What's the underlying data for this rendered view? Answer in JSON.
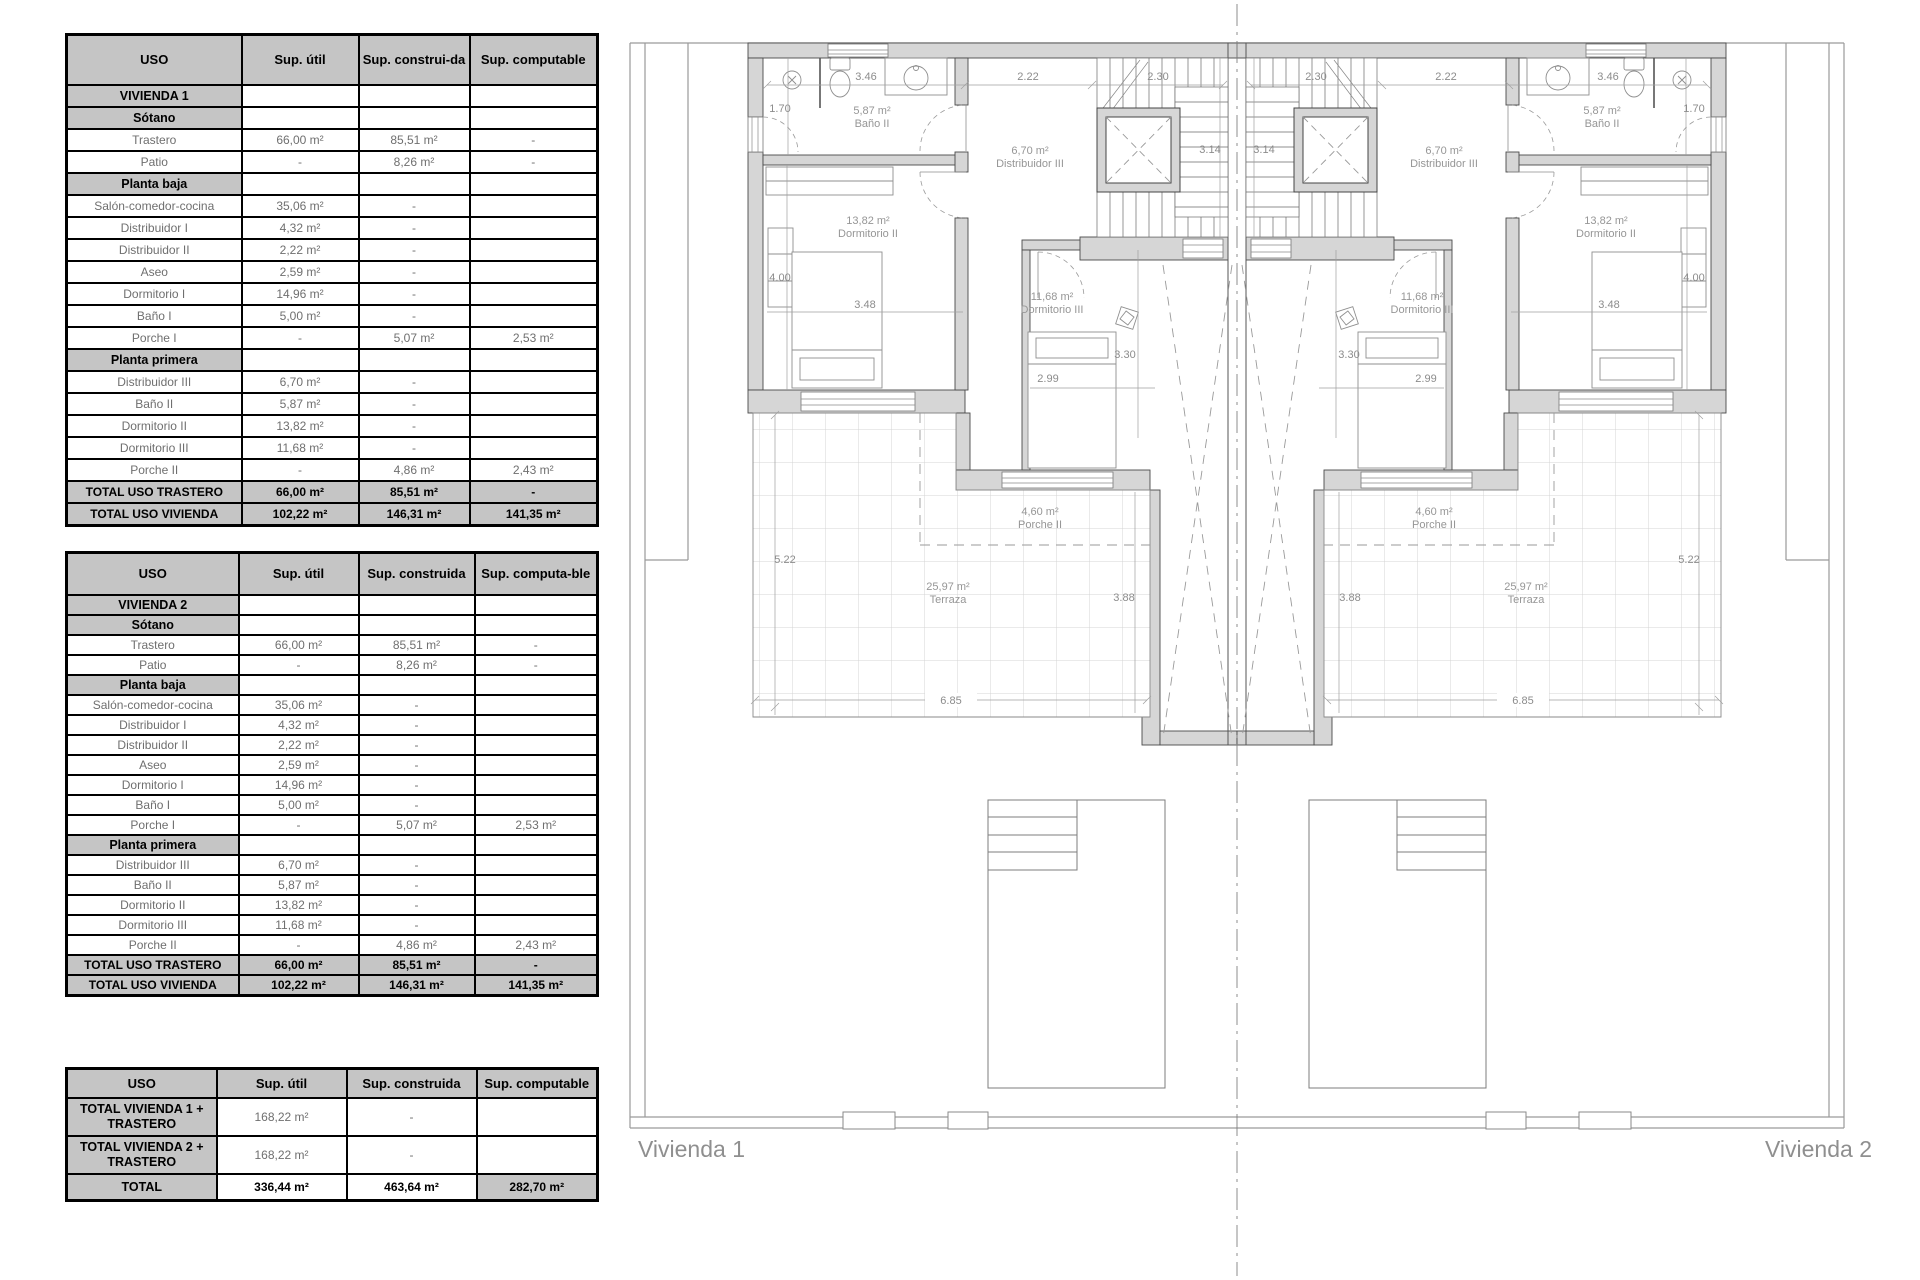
{
  "tables": {
    "table1": {
      "colw": [
        175,
        117,
        111,
        128
      ],
      "headers": [
        "USO",
        "Sup. útil",
        "Sup. construi-da",
        "Sup. computable"
      ],
      "rows": [
        [
          {
            "t": "VIVIENDA 1",
            "c": "sec"
          },
          {
            "t": "",
            "c": ""
          },
          {
            "t": "",
            "c": ""
          },
          {
            "t": "",
            "c": ""
          }
        ],
        [
          {
            "t": "Sótano",
            "c": "sec"
          },
          {
            "t": "",
            "c": ""
          },
          {
            "t": "",
            "c": ""
          },
          {
            "t": "",
            "c": ""
          }
        ],
        [
          {
            "t": "Trastero",
            "c": "dat"
          },
          {
            "t": "66,00 m²",
            "c": "dat"
          },
          {
            "t": "85,51 m²",
            "c": "dat"
          },
          {
            "t": "-",
            "c": "dat"
          }
        ],
        [
          {
            "t": "Patio",
            "c": "dat"
          },
          {
            "t": "-",
            "c": "dat"
          },
          {
            "t": "8,26 m²",
            "c": "dat"
          },
          {
            "t": "-",
            "c": "dat"
          }
        ],
        [
          {
            "t": "Planta baja",
            "c": "sec"
          },
          {
            "t": "",
            "c": ""
          },
          {
            "t": "",
            "c": ""
          },
          {
            "t": "",
            "c": ""
          }
        ],
        [
          {
            "t": "Salón-comedor-cocina",
            "c": "dat"
          },
          {
            "t": "35,06 m²",
            "c": "dat"
          },
          {
            "t": "-",
            "c": "dat"
          },
          {
            "t": "",
            "c": ""
          }
        ],
        [
          {
            "t": "Distribuidor I",
            "c": "dat"
          },
          {
            "t": "4,32 m²",
            "c": "dat"
          },
          {
            "t": "-",
            "c": "dat"
          },
          {
            "t": "",
            "c": ""
          }
        ],
        [
          {
            "t": "Distribuidor II",
            "c": "dat"
          },
          {
            "t": "2,22 m²",
            "c": "dat"
          },
          {
            "t": "-",
            "c": "dat"
          },
          {
            "t": "",
            "c": ""
          }
        ],
        [
          {
            "t": "Aseo",
            "c": "dat"
          },
          {
            "t": "2,59 m²",
            "c": "dat"
          },
          {
            "t": "-",
            "c": "dat"
          },
          {
            "t": "",
            "c": ""
          }
        ],
        [
          {
            "t": "Dormitorio I",
            "c": "dat"
          },
          {
            "t": "14,96 m²",
            "c": "dat"
          },
          {
            "t": "-",
            "c": "dat"
          },
          {
            "t": "",
            "c": ""
          }
        ],
        [
          {
            "t": "Baño I",
            "c": "dat"
          },
          {
            "t": "5,00 m²",
            "c": "dat"
          },
          {
            "t": "-",
            "c": "dat"
          },
          {
            "t": "",
            "c": ""
          }
        ],
        [
          {
            "t": "Porche I",
            "c": "dat"
          },
          {
            "t": "-",
            "c": "dat"
          },
          {
            "t": "5,07 m²",
            "c": "dat"
          },
          {
            "t": "2,53 m²",
            "c": "dat"
          }
        ],
        [
          {
            "t": "Planta primera",
            "c": "sec"
          },
          {
            "t": "",
            "c": ""
          },
          {
            "t": "",
            "c": ""
          },
          {
            "t": "",
            "c": ""
          }
        ],
        [
          {
            "t": "Distribuidor III",
            "c": "dat"
          },
          {
            "t": "6,70 m²",
            "c": "dat"
          },
          {
            "t": "-",
            "c": "dat"
          },
          {
            "t": "",
            "c": ""
          }
        ],
        [
          {
            "t": "Baño II",
            "c": "dat"
          },
          {
            "t": "5,87 m²",
            "c": "dat"
          },
          {
            "t": "-",
            "c": "dat"
          },
          {
            "t": "",
            "c": ""
          }
        ],
        [
          {
            "t": "Dormitorio II",
            "c": "dat"
          },
          {
            "t": "13,82 m²",
            "c": "dat"
          },
          {
            "t": "-",
            "c": "dat"
          },
          {
            "t": "",
            "c": ""
          }
        ],
        [
          {
            "t": "Dormitorio III",
            "c": "dat"
          },
          {
            "t": "11,68 m²",
            "c": "dat"
          },
          {
            "t": "-",
            "c": "dat"
          },
          {
            "t": "",
            "c": ""
          }
        ],
        [
          {
            "t": "Porche II",
            "c": "dat"
          },
          {
            "t": "-",
            "c": "dat"
          },
          {
            "t": "4,86 m²",
            "c": "dat"
          },
          {
            "t": "2,43 m²",
            "c": "dat"
          }
        ],
        [
          {
            "t": "TOTAL USO TRASTERO",
            "c": "tot"
          },
          {
            "t": "66,00 m²",
            "c": "tot"
          },
          {
            "t": "85,51 m²",
            "c": "tot"
          },
          {
            "t": "-",
            "c": "tot"
          }
        ],
        [
          {
            "t": "TOTAL USO VIVIENDA",
            "c": "tot"
          },
          {
            "t": "102,22 m²",
            "c": "tot"
          },
          {
            "t": "146,31 m²",
            "c": "tot"
          },
          {
            "t": "141,35 m²",
            "c": "tot"
          }
        ]
      ]
    },
    "table2": {
      "colw": [
        172,
        120,
        116,
        123
      ],
      "headers": [
        "USO",
        "Sup. útil",
        "Sup. construida",
        "Sup. computa-ble"
      ],
      "rows": [
        [
          {
            "t": "VIVIENDA 2",
            "c": "sec"
          },
          {
            "t": "",
            "c": ""
          },
          {
            "t": "",
            "c": ""
          },
          {
            "t": "",
            "c": ""
          }
        ],
        [
          {
            "t": "Sótano",
            "c": "sec"
          },
          {
            "t": "",
            "c": ""
          },
          {
            "t": "",
            "c": ""
          },
          {
            "t": "",
            "c": ""
          }
        ],
        [
          {
            "t": "Trastero",
            "c": "dat"
          },
          {
            "t": "66,00 m²",
            "c": "dat"
          },
          {
            "t": "85,51 m²",
            "c": "dat"
          },
          {
            "t": "-",
            "c": "dat"
          }
        ],
        [
          {
            "t": "Patio",
            "c": "dat"
          },
          {
            "t": "-",
            "c": "dat"
          },
          {
            "t": "8,26 m²",
            "c": "dat"
          },
          {
            "t": "-",
            "c": "dat"
          }
        ],
        [
          {
            "t": "Planta baja",
            "c": "sec"
          },
          {
            "t": "",
            "c": ""
          },
          {
            "t": "",
            "c": ""
          },
          {
            "t": "",
            "c": ""
          }
        ],
        [
          {
            "t": "Salón-comedor-cocina",
            "c": "dat"
          },
          {
            "t": "35,06 m²",
            "c": "dat"
          },
          {
            "t": "-",
            "c": "dat"
          },
          {
            "t": "",
            "c": ""
          }
        ],
        [
          {
            "t": "Distribuidor I",
            "c": "dat"
          },
          {
            "t": "4,32 m²",
            "c": "dat"
          },
          {
            "t": "-",
            "c": "dat"
          },
          {
            "t": "",
            "c": ""
          }
        ],
        [
          {
            "t": "Distribuidor II",
            "c": "dat"
          },
          {
            "t": "2,22 m²",
            "c": "dat"
          },
          {
            "t": "-",
            "c": "dat"
          },
          {
            "t": "",
            "c": ""
          }
        ],
        [
          {
            "t": "Aseo",
            "c": "dat"
          },
          {
            "t": "2,59 m²",
            "c": "dat"
          },
          {
            "t": "-",
            "c": "dat"
          },
          {
            "t": "",
            "c": ""
          }
        ],
        [
          {
            "t": "Dormitorio I",
            "c": "dat"
          },
          {
            "t": "14,96 m²",
            "c": "dat"
          },
          {
            "t": "-",
            "c": "dat"
          },
          {
            "t": "",
            "c": ""
          }
        ],
        [
          {
            "t": "Baño I",
            "c": "dat"
          },
          {
            "t": "5,00 m²",
            "c": "dat"
          },
          {
            "t": "-",
            "c": "dat"
          },
          {
            "t": "",
            "c": ""
          }
        ],
        [
          {
            "t": "Porche I",
            "c": "dat"
          },
          {
            "t": "-",
            "c": "dat"
          },
          {
            "t": "5,07 m²",
            "c": "dat"
          },
          {
            "t": "2,53 m²",
            "c": "dat"
          }
        ],
        [
          {
            "t": "Planta primera",
            "c": "sec"
          },
          {
            "t": "",
            "c": ""
          },
          {
            "t": "",
            "c": ""
          },
          {
            "t": "",
            "c": ""
          }
        ],
        [
          {
            "t": "Distribuidor III",
            "c": "dat"
          },
          {
            "t": "6,70 m²",
            "c": "dat"
          },
          {
            "t": "-",
            "c": "dat"
          },
          {
            "t": "",
            "c": ""
          }
        ],
        [
          {
            "t": "Baño II",
            "c": "dat"
          },
          {
            "t": "5,87 m²",
            "c": "dat"
          },
          {
            "t": "-",
            "c": "dat"
          },
          {
            "t": "",
            "c": ""
          }
        ],
        [
          {
            "t": "Dormitorio II",
            "c": "dat"
          },
          {
            "t": "13,82 m²",
            "c": "dat"
          },
          {
            "t": "-",
            "c": "dat"
          },
          {
            "t": "",
            "c": ""
          }
        ],
        [
          {
            "t": "Dormitorio III",
            "c": "dat"
          },
          {
            "t": "11,68 m²",
            "c": "dat"
          },
          {
            "t": "-",
            "c": "dat"
          },
          {
            "t": "",
            "c": ""
          }
        ],
        [
          {
            "t": "Porche II",
            "c": "dat"
          },
          {
            "t": "-",
            "c": "dat"
          },
          {
            "t": "4,86 m²",
            "c": "dat"
          },
          {
            "t": "2,43 m²",
            "c": "dat"
          }
        ],
        [
          {
            "t": "TOTAL USO TRASTERO",
            "c": "tot"
          },
          {
            "t": "66,00 m²",
            "c": "tot"
          },
          {
            "t": "85,51 m²",
            "c": "tot"
          },
          {
            "t": "-",
            "c": "tot"
          }
        ],
        [
          {
            "t": "TOTAL USO VIVIENDA",
            "c": "tot"
          },
          {
            "t": "102,22 m²",
            "c": "tot"
          },
          {
            "t": "146,31 m²",
            "c": "tot"
          },
          {
            "t": "141,35 m²",
            "c": "tot"
          }
        ]
      ]
    },
    "table3": {
      "colw": [
        150,
        130,
        130,
        121
      ],
      "headers": [
        "USO",
        "Sup. útil",
        "Sup. construida",
        "Sup. computable"
      ],
      "rows": [
        [
          {
            "t": "TOTAL VIVIENDA 1 + TRASTERO",
            "c": "sec"
          },
          {
            "t": "168,22 m²",
            "c": "dat"
          },
          {
            "t": "-",
            "c": "dat"
          },
          {
            "t": "",
            "c": ""
          }
        ],
        [
          {
            "t": "TOTAL VIVIENDA 2 + TRASTERO",
            "c": "sec"
          },
          {
            "t": "168,22 m²",
            "c": "dat"
          },
          {
            "t": "-",
            "c": "dat"
          },
          {
            "t": "",
            "c": ""
          }
        ],
        [
          {
            "t": "TOTAL",
            "c": "sec"
          },
          {
            "t": "336,44 m²",
            "c": "totv"
          },
          {
            "t": "463,64  m²",
            "c": "totv"
          },
          {
            "t": "282,70  m²",
            "c": "tot"
          }
        ]
      ]
    }
  },
  "plan": {
    "title_left": "Vivienda 1",
    "title_right": "Vivienda 2",
    "rooms": {
      "bano": {
        "area": "5,87 m²",
        "name": "Baño II"
      },
      "distribuidor": {
        "area": "6,70 m²",
        "name": "Distribuidor III"
      },
      "dormitorio2": {
        "area": "13,82 m²",
        "name": "Dormitorio II"
      },
      "dormitorio3": {
        "area": "11,68 m²",
        "name": "Dormitorio III"
      },
      "porche": {
        "area": "4,60 m²",
        "name": "Porche II"
      },
      "terraza": {
        "area": "25,97 m²",
        "name": "Terraza"
      }
    },
    "dims": {
      "a": "1.70",
      "b": "3.46",
      "c": "2.22",
      "d": "2.30",
      "e": "3.14",
      "f": "4.00",
      "g": "3.48",
      "h": "2.99",
      "i": "3.30",
      "j": "5.22",
      "k": "3.88",
      "l": "6.85"
    }
  },
  "colors": {
    "table_header_bg": "#c5c5c5",
    "wall_fill": "#d6d6d6",
    "line": "#555555",
    "label_gray": "#969696"
  }
}
